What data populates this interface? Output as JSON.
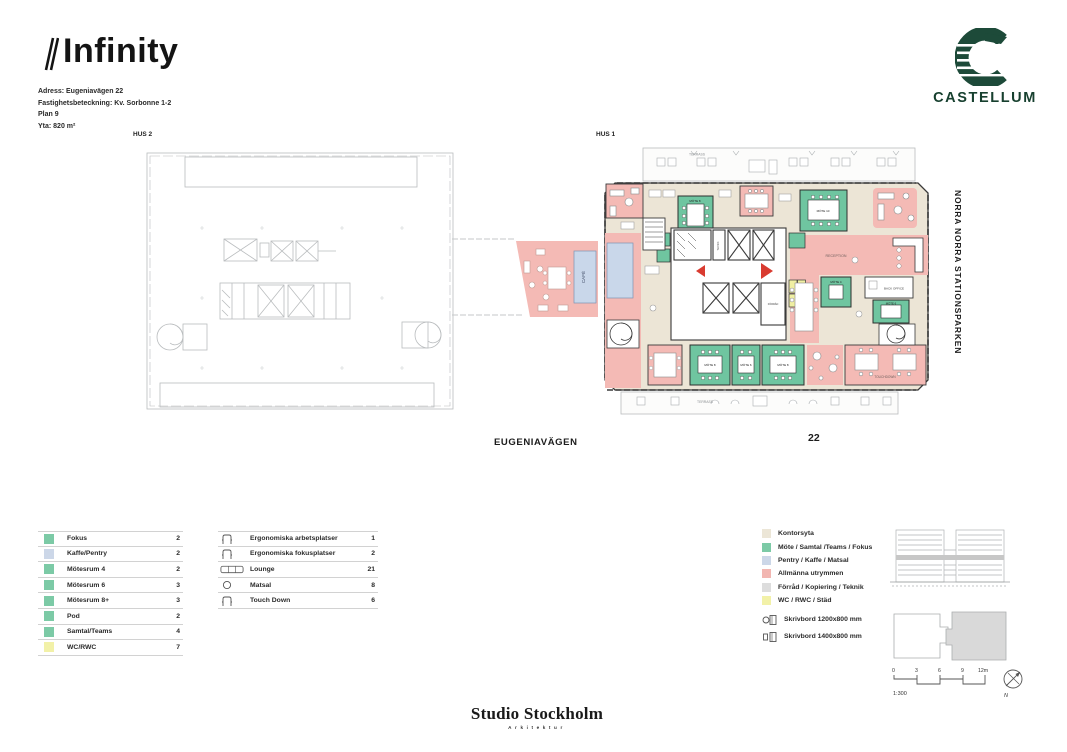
{
  "header": {
    "title": "Infinity",
    "line1": "Adress: Eugeniavägen 22",
    "line2": "Fastighetsbeteckning: Kv. Sorbonne 1-2",
    "line3": "Plan 9",
    "line4": "Yta: 820 m²"
  },
  "brand": {
    "castellum": "CASTELLUM",
    "castellum_color": "#17402f",
    "studio": "Studio Stockholm",
    "studio_sub": "Arkitektur"
  },
  "plan": {
    "hus1": "HUS 1",
    "hus2": "HUS 2",
    "street": "EUGENIAVÄGEN",
    "street_number": "22",
    "park": "NORRA NORRA STATIONSPARKEN",
    "rooms": {
      "terrass_top": "TERRASS",
      "terrass_bottom": "TERRASS",
      "mote8_nw": "MÖTE 8",
      "mote10": "MÖTE 10",
      "reception": "RECEPTION",
      "back_office": "BACK OFFICE",
      "touchdown": "TOUCHDOWN",
      "mote8_s1": "MÖTE 8",
      "mote6_s": "MÖTE 6",
      "mote8_s2": "MÖTE 8",
      "mote4_e": "MÖTE 4",
      "mote6_e": "MÖTE 6",
      "teknik": "TEKNIK",
      "forrad": "FÖRRÅD",
      "cafe": "CAFÉ"
    }
  },
  "legend_rooms": {
    "rows": [
      {
        "label": "Fokus",
        "count": "2",
        "color": "#7ccaa6"
      },
      {
        "label": "Kaffe/Pentry",
        "count": "2",
        "color": "#ccd7e8"
      },
      {
        "label": "Mötesrum 4",
        "count": "2",
        "color": "#7ccaa6"
      },
      {
        "label": "Mötesrum 6",
        "count": "3",
        "color": "#7ccaa6"
      },
      {
        "label": "Mötesrum 8+",
        "count": "3",
        "color": "#7ccaa6"
      },
      {
        "label": "Pod",
        "count": "2",
        "color": "#7ccaa6"
      },
      {
        "label": "Samtal/Teams",
        "count": "4",
        "color": "#7ccaa6"
      },
      {
        "label": "WC/RWC",
        "count": "7",
        "color": "#f2f1a8"
      }
    ]
  },
  "legend_workplaces": {
    "rows": [
      {
        "label": "Ergonomiska arbetsplatser",
        "count": "1",
        "icon": "chair"
      },
      {
        "label": "Ergonomiska fokusplatser",
        "count": "2",
        "icon": "chair"
      },
      {
        "label": "Lounge",
        "count": "21",
        "icon": "sofa"
      },
      {
        "label": "Matsal",
        "count": "8",
        "icon": "stool"
      },
      {
        "label": "Touch Down",
        "count": "6",
        "icon": "chair"
      }
    ]
  },
  "legend_zones": {
    "rows": [
      {
        "label": "Kontorsyta",
        "color": "#ece6d7"
      },
      {
        "label": "Möte / Samtal /Teams / Fokus",
        "color": "#7ccaa6"
      },
      {
        "label": "Pentry / Kaffe / Matsal",
        "color": "#ccd7e8"
      },
      {
        "label": "Allmänna utrymmen",
        "color": "#f2b6b1"
      },
      {
        "label": "Förråd / Kopiering / Teknik",
        "color": "#dddddd"
      },
      {
        "label": "WC / RWC / Städ",
        "color": "#f2f1a8"
      }
    ],
    "desk1": "Skrivbord 1200x800 mm",
    "desk2": "Skrivbord 1400x800 mm"
  },
  "scale": {
    "t0": "0",
    "t1": "3",
    "t2": "6",
    "t3": "9",
    "t4": "12m",
    "ratio": "1:300",
    "north": "N"
  },
  "colors": {
    "wall": "#3a3a3a",
    "faded_plan": "#b6babc",
    "beige": "#ece5d6",
    "pink": "#f4bab5",
    "green": "#6fc5a0",
    "yellow": "#f0efa2",
    "blue": "#c9d7ea",
    "red_arrow": "#d93b30"
  }
}
